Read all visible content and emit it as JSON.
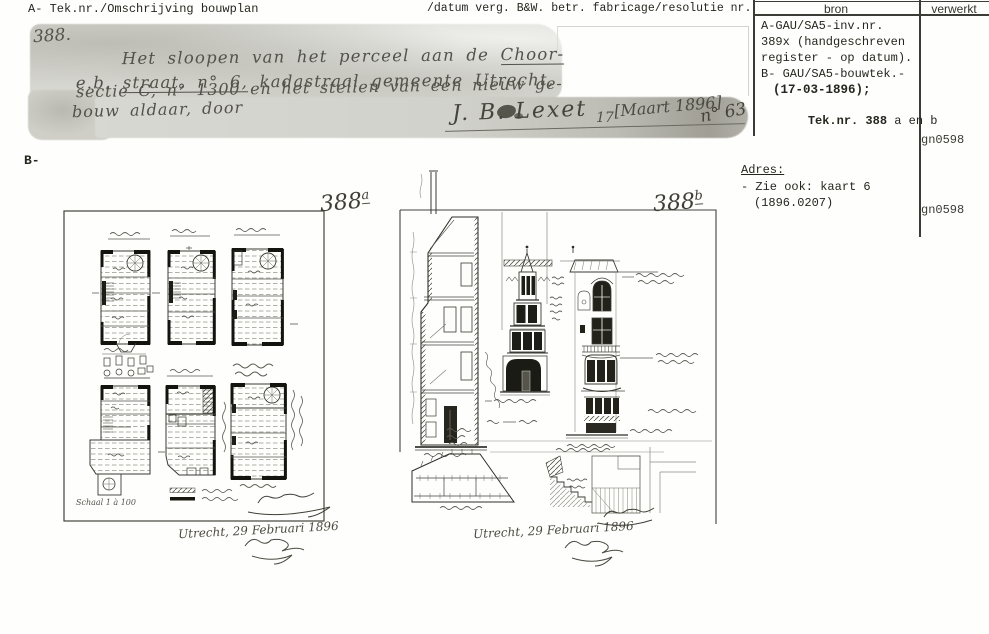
{
  "header": {
    "left": "A- Tek.nr./Omschrijving bouwplan",
    "right": "/datum verg. B&W. betr. fabricage/resolutie nr."
  },
  "bron_table": {
    "bron_header": "bron",
    "verwerkt_header": "verwerkt",
    "line1": "A-GAU/SA5-inv.nr.",
    "line2": "389x (handgeschreven",
    "line3": "register - op datum).",
    "line4": "B- GAU/SA5-bouwtek.-",
    "date_line": "(17-03-1896);",
    "tek_bold": "Tek.nr. 388",
    "tek_rest": " a en b",
    "verwerkt_top": "gn0598",
    "verwerkt_bottom": "gn0598"
  },
  "adres": {
    "label": "Adres:",
    "line1": "- Zie ook: kaart 6",
    "line2": "(1896.0207)"
  },
  "section_label": "B-",
  "note": {
    "number": "388.",
    "line1_pre": "Het sloopen van het perceel aan de ",
    "line1_u": "Choor-",
    "line2_pre": "e.b. ",
    "line2_u": "straat, n° 6,",
    "line2_post": " kadastraal gemeente Utrecht,",
    "line3": "sectie C, n° 1300 en het stellen van een nieuw ge-",
    "line4": "bouw aldaar, door",
    "signature": "J. B. Lexet",
    "day": "17",
    "bracket": "[Maart 1896]",
    "dossier": "n° 63"
  },
  "sheet_a": {
    "title_num": "388",
    "title_sup": "a",
    "scale_label": "Schaal 1 à 100",
    "date_line": "Utrecht, 29 Februari 1896"
  },
  "sheet_b": {
    "title_num": "388",
    "title_sup": "b",
    "date_line": "Utrecht, 29 Februari 1896"
  }
}
